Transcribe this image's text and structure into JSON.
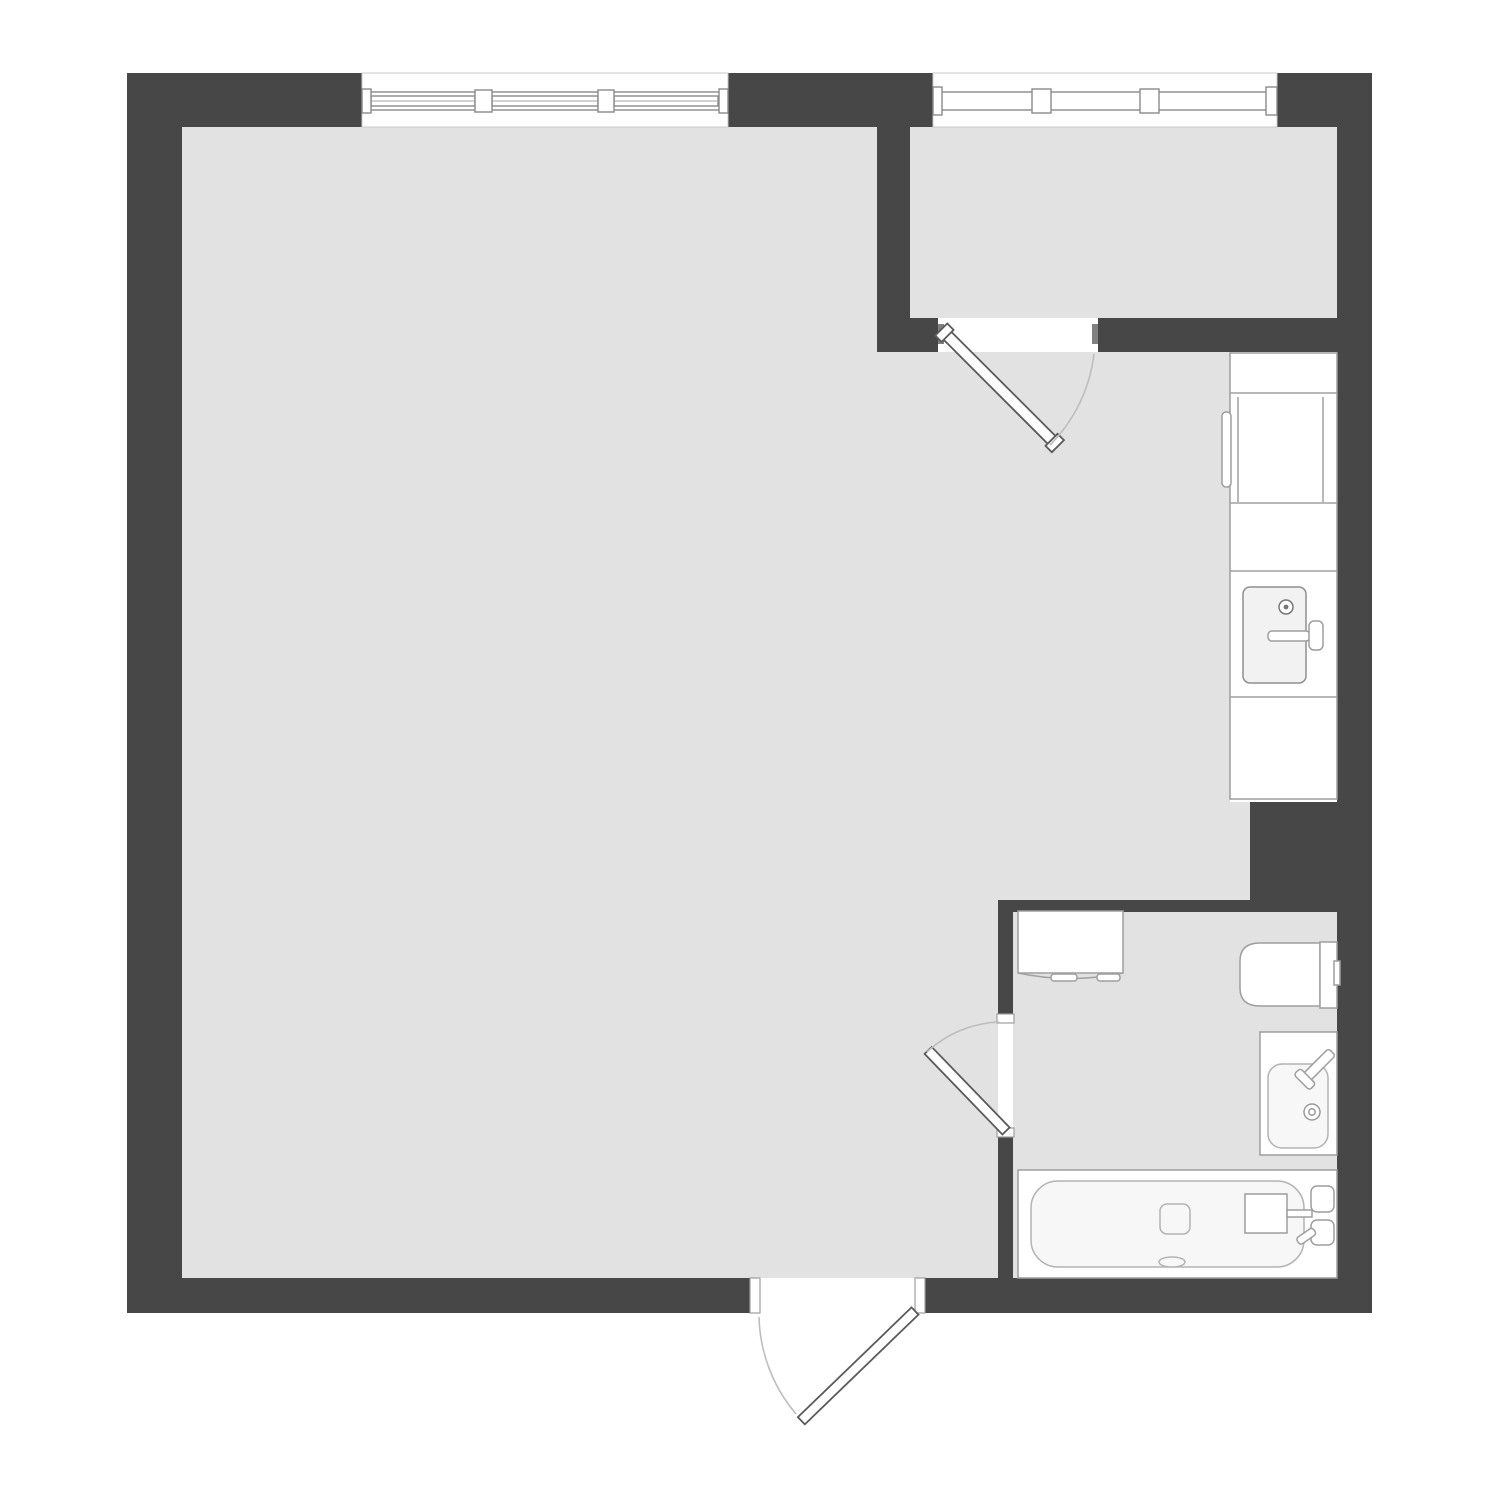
{
  "canvas": {
    "width": 1500,
    "height": 1500,
    "background": "#ffffff"
  },
  "palette": {
    "wall": "#474747",
    "floor": "#e2e2e2",
    "white": "#ffffff",
    "fixture_stroke": "#9e9e9e",
    "door_leaf_stroke": "#5a5a5a",
    "swing_arc": "#bdbdbd",
    "jamb_mark": "#808080"
  },
  "plan": {
    "type": "studio-apartment-floor-plan",
    "rooms": [
      {
        "id": "main-room"
      },
      {
        "id": "balcony"
      },
      {
        "id": "kitchen-area"
      },
      {
        "id": "bathroom"
      }
    ],
    "windows": [
      {
        "id": "main-window",
        "panes": 3
      },
      {
        "id": "balcony-window",
        "panes": 3
      }
    ],
    "doors": [
      {
        "id": "balcony-door",
        "swing": "into-kitchen"
      },
      {
        "id": "bathroom-door",
        "swing": "into-main-room"
      },
      {
        "id": "entry-door",
        "swing": "outward"
      }
    ],
    "fixtures": [
      {
        "id": "kitchen-counter"
      },
      {
        "id": "fridge"
      },
      {
        "id": "kitchen-sink"
      },
      {
        "id": "washing-machine"
      },
      {
        "id": "toilet"
      },
      {
        "id": "bathroom-sink"
      },
      {
        "id": "bathtub"
      }
    ]
  }
}
